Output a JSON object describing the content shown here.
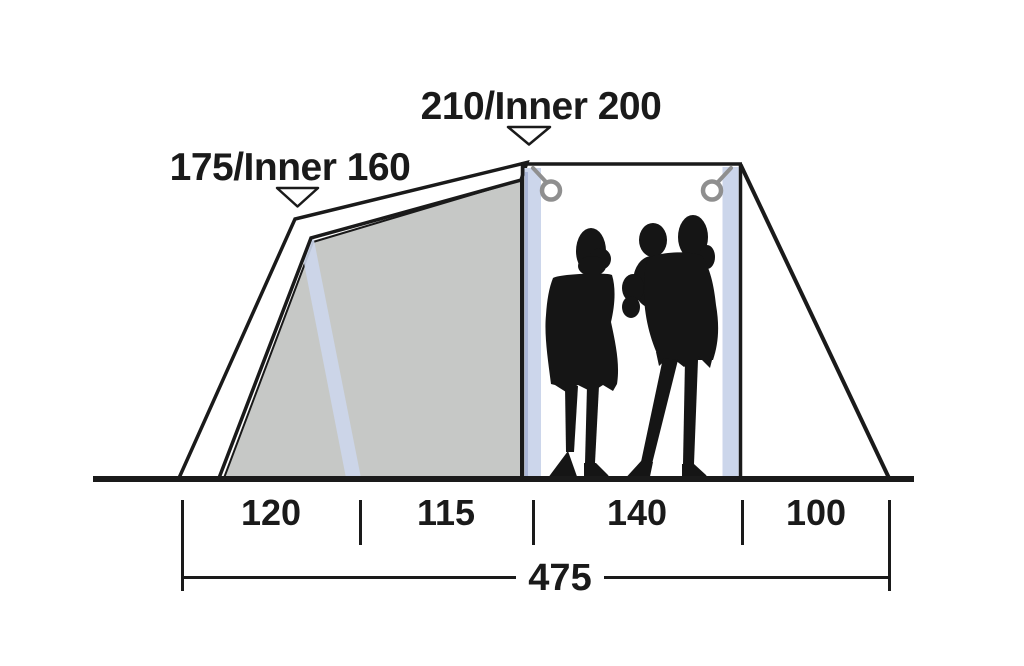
{
  "diagram": {
    "height_labels": [
      {
        "id": "left-peak",
        "label": "175/Inner 160"
      },
      {
        "id": "center-peak",
        "label": "210/Inner 200"
      }
    ],
    "ground_segments": [
      {
        "label": "120"
      },
      {
        "label": "115"
      },
      {
        "label": "140"
      },
      {
        "label": "100"
      }
    ],
    "total_length_label": "475",
    "colors": {
      "line": "#1a1a1a",
      "panel_gray": "#c6c8c6",
      "pole_blue": "#ccd6eb",
      "pole_shade_blue": "#aab6d6",
      "ring_gray": "#8f8f8f",
      "silhouette": "#151515"
    }
  }
}
